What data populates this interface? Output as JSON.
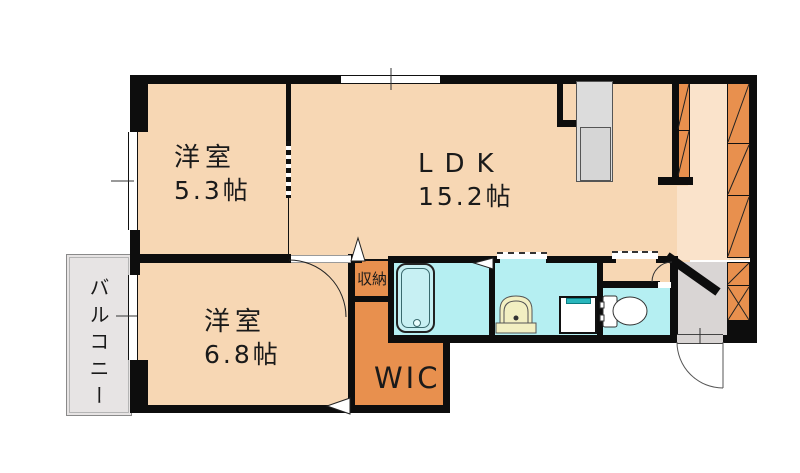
{
  "floorplan": {
    "rooms": {
      "bedroom1": {
        "name": "洋室",
        "size": "5.3帖"
      },
      "ldk": {
        "name": "LDK",
        "size": "15.2帖"
      },
      "bedroom2": {
        "name": "洋室",
        "size": "6.8帖"
      },
      "wic": {
        "name": "WIC"
      },
      "storage": {
        "name": "収納"
      },
      "balcony": {
        "name": "バルコニー"
      }
    },
    "colors": {
      "room_fill": "#f7d7b4",
      "corridor_fill": "#fae3cb",
      "closet_fill": "#e8904e",
      "wet_area_fill": "#b5eff2",
      "balcony_fill": "#e7e4e4",
      "entry_fill": "#d9d5d4",
      "counter_fill": "#dcdcdc",
      "washer_accent": "#28b6bc",
      "basin_fill": "#f2efc2",
      "wall": "#0d0d0d"
    }
  }
}
